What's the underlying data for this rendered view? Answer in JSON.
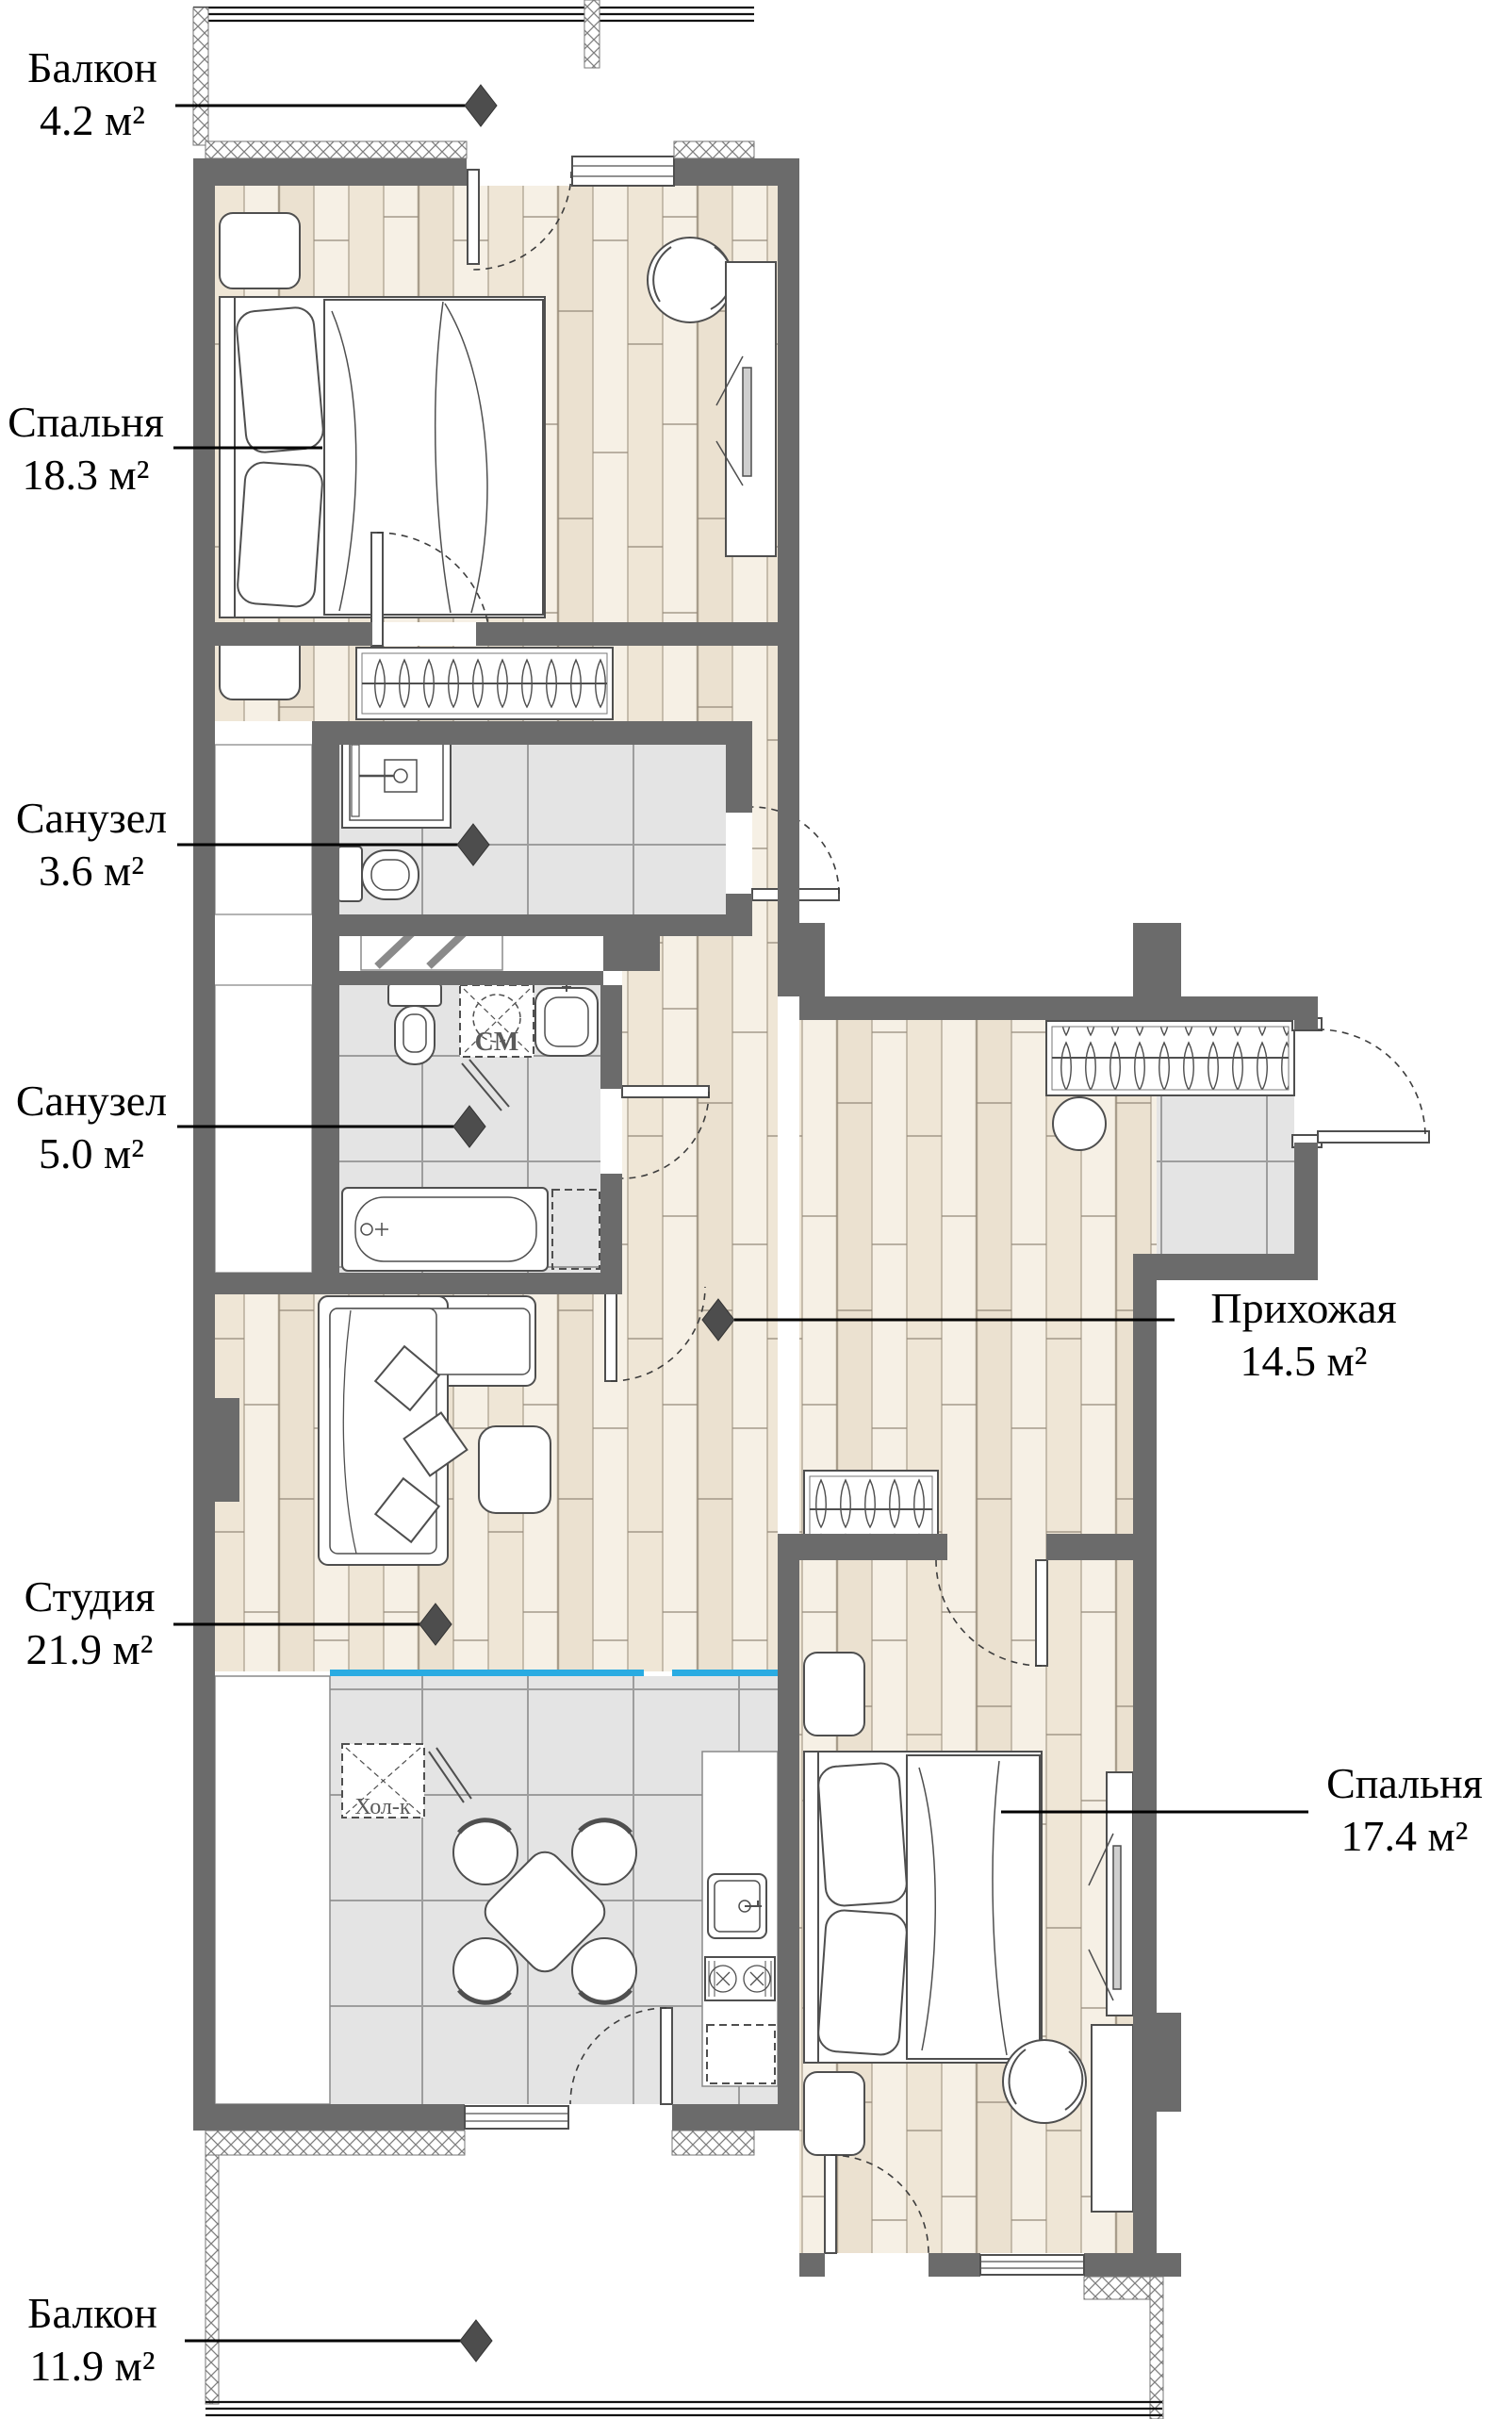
{
  "labels": [
    {
      "name": "Балкон",
      "area": "4.2 м²"
    },
    {
      "name": "Спальня",
      "area": "18.3 м²"
    },
    {
      "name": "Санузел",
      "area": "3.6 м²"
    },
    {
      "name": "Санузел",
      "area": "5.0 м²"
    },
    {
      "name": "Студия",
      "area": "21.9 м²"
    },
    {
      "name": "Балкон",
      "area": "11.9 м²"
    },
    {
      "name": "Прихожая",
      "area": "14.5 м²"
    },
    {
      "name": "Спальня",
      "area": "17.4 м²"
    }
  ],
  "plan_texts": {
    "fridge": "Хол-к",
    "washing_machine": "СМ"
  },
  "colors": {
    "wall": "#6b6b6b",
    "parquet": "#ebe1d0",
    "tile": "#e4e4e4",
    "counter_accent": "#29abe2",
    "marker": "#4d4d4d"
  }
}
